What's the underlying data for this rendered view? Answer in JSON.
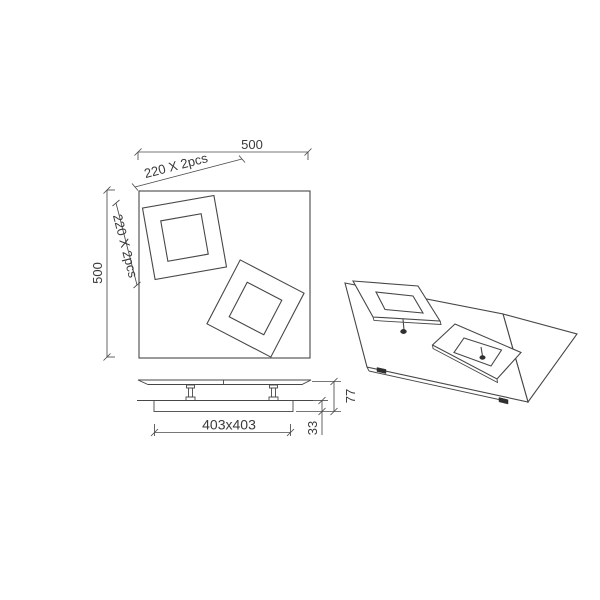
{
  "colors": {
    "background": "#ffffff",
    "line": "#474747",
    "text": "#3a3a3a"
  },
  "front_view": {
    "width_label": "500",
    "height_label": "500",
    "top_frames_label": "220 X 2pcs",
    "left_frames_label": "220 X 2pcs"
  },
  "side_view": {
    "base_size_label": "403x403",
    "height_label": "77",
    "thickness_label": "33"
  }
}
